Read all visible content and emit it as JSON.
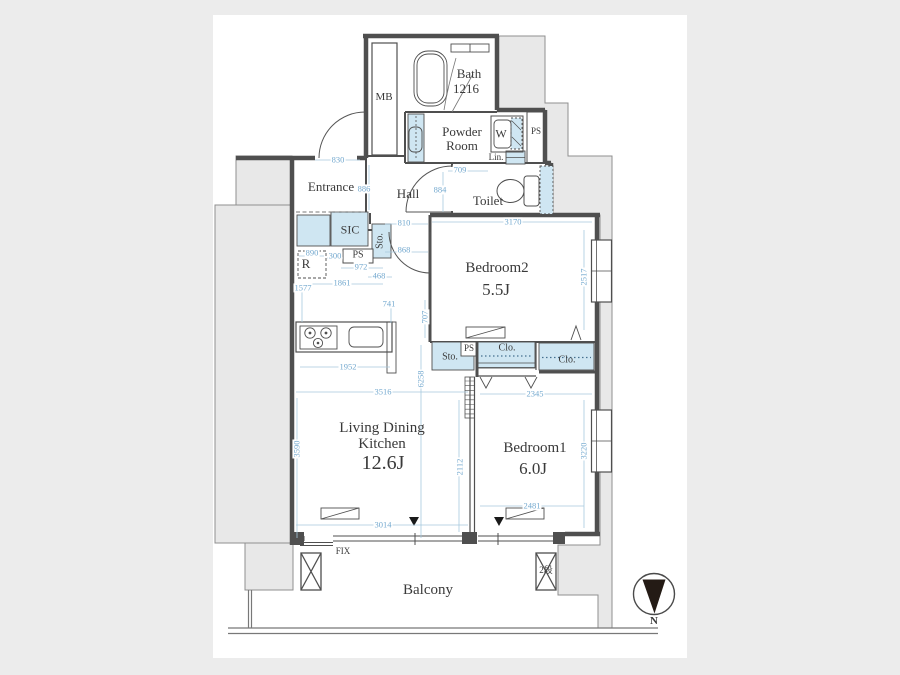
{
  "labels": {
    "mb": "MB",
    "bath_name": "Bath",
    "bath_size": "1216",
    "powder_room": "Powder Room",
    "washer": "W",
    "ps_upper": "PS",
    "linen": "Lin.",
    "toilet": "Toilet",
    "entrance": "Entrance",
    "hall": "Hall",
    "sic": "SIC",
    "storage_hall": "Sto.",
    "ps_hall": "PS",
    "fridge": "R",
    "bedroom2_name": "Bedroom2",
    "bedroom2_size": "5.5J",
    "storage_mid": "Sto.",
    "ps_mid": "PS",
    "closet1": "Clo.",
    "closet2": "Clo.",
    "ldk_name": "Living Dining Kitchen",
    "ldk_size": "12.6J",
    "bedroom1_name": "Bedroom1",
    "bedroom1_size": "6.0J",
    "balcony": "Balcony",
    "fix": "FIX",
    "balcony_step": "2段",
    "compass_north": "N"
  },
  "dims": {
    "entrance_door": "830",
    "entrance_depth": "886",
    "hall_depth": "884",
    "powder_entry": "709",
    "hall_passage": "810",
    "hall_lower": "868",
    "kitchen_pass": "972",
    "kitchen_return": "468",
    "ps_width": "300",
    "fridge_width": "890",
    "kitchen_width": "1861",
    "kitchen_left": "1577",
    "counter_depth": "741",
    "wall_section": "707",
    "bedroom2_width": "3170",
    "bedroom2_depth": "2517",
    "counter_length": "1952",
    "ldk_length": "6258",
    "ldk_width": "3516",
    "ldk_depth": "3590",
    "partition": "2112",
    "ldk_bottom": "3014",
    "bedroom1_top": "2345",
    "bedroom1_depth": "3220",
    "bedroom1_bottom": "2481"
  },
  "colors": {
    "storage_fill": "#cfe6f2",
    "dimension_blue": "#74a9cf",
    "wall_gray": "#4f4f4f",
    "exterior_gray": "#e8e8e8"
  }
}
